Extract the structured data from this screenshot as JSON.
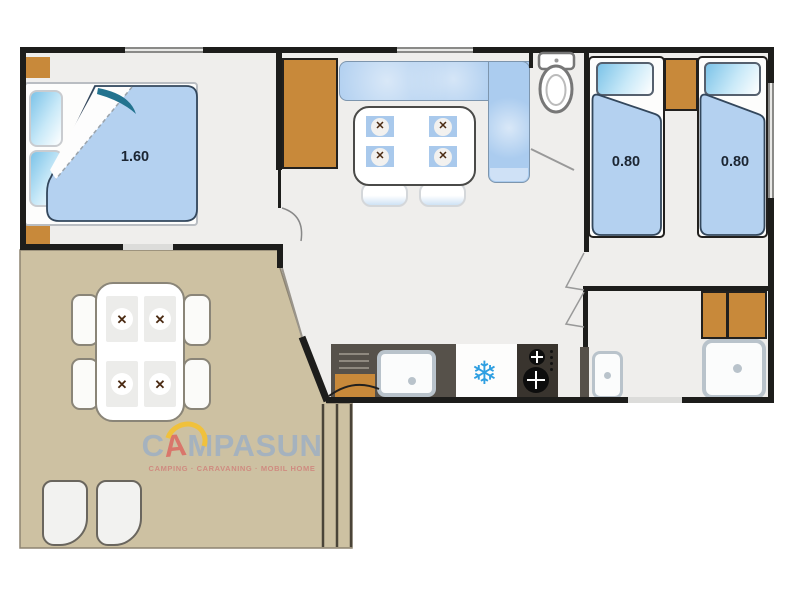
{
  "floor_plan": {
    "master_bedroom": {
      "bed_width_label": "1.60"
    },
    "twin_bedroom": {
      "bed1_width_label": "0.80",
      "bed2_width_label": "0.80"
    }
  },
  "brand": {
    "part1": "C",
    "styled_a": "A",
    "part2": "MPASUN",
    "tagline": "CAMPING · CARAVANING · MOBIL HOME"
  },
  "icons": {
    "snowflake_glyph": "❄",
    "cutlery_glyph": "✕"
  },
  "colors": {
    "wall_black": "#1d1d1b",
    "wood_orange": "#c8893a",
    "fabric_blue": "#aecdf0",
    "terrace_beige": "#cdc1a2",
    "counter_gray": "#56514a",
    "snowflake_blue": "#2f9fe1",
    "logo_gray": "#a5b2be",
    "logo_red": "#d9766b",
    "logo_yellow": "#f0c13c"
  }
}
